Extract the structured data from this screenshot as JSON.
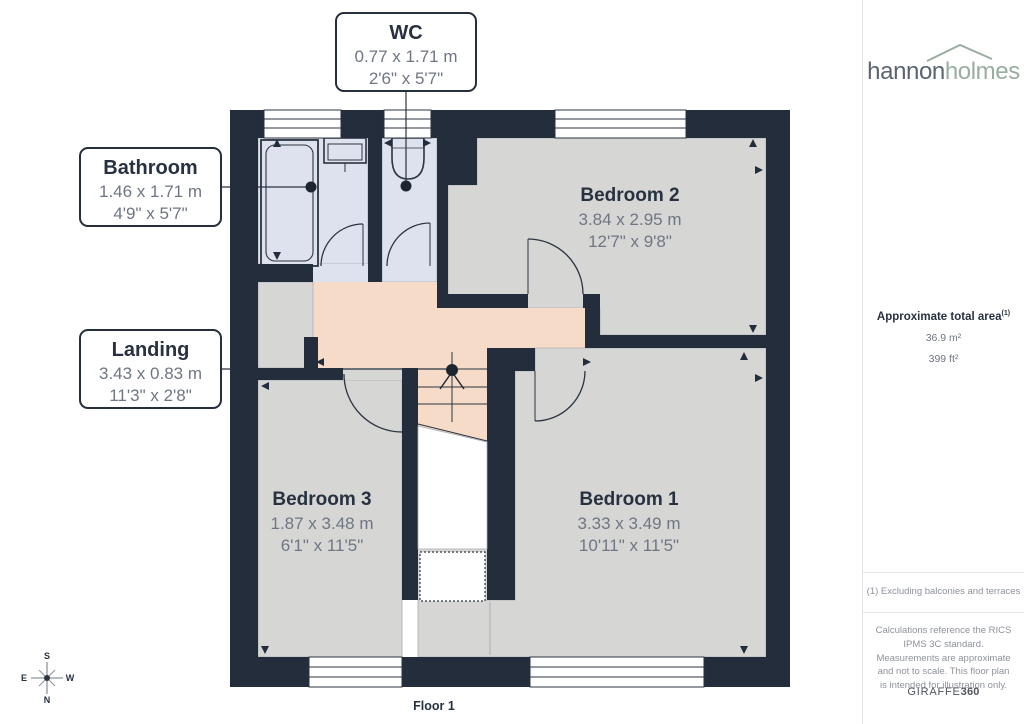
{
  "plan": {
    "floor_label": "Floor 1",
    "callouts": {
      "wc": {
        "title": "WC",
        "metric": "0.77 x 1.71 m",
        "imperial": "2'6\" x 5'7\""
      },
      "bathroom": {
        "title": "Bathroom",
        "metric": "1.46 x 1.71 m",
        "imperial": "4'9\" x 5'7\""
      },
      "landing": {
        "title": "Landing",
        "metric": "3.43 x 0.83 m",
        "imperial": "11'3\" x 2'8\""
      }
    },
    "rooms": {
      "bedroom2": {
        "title": "Bedroom 2",
        "metric": "3.84 x 2.95 m",
        "imperial": "12'7\" x 9'8\""
      },
      "bedroom3": {
        "title": "Bedroom 3",
        "metric": "1.87 x 3.48 m",
        "imperial": "6'1\" x 11'5\""
      },
      "bedroom1": {
        "title": "Bedroom 1",
        "metric": "3.33 x 3.49 m",
        "imperial": "10'11\" x 11'5\""
      }
    },
    "compass": {
      "top": "S",
      "left": "E",
      "right": "W",
      "bottom": "N"
    }
  },
  "sidebar": {
    "logo": {
      "part1": "hannon",
      "part2": "holmes"
    },
    "area": {
      "label": "Approximate total area",
      "sup": "(1)",
      "metric": "36.9 m²",
      "imperial": "399 ft²"
    },
    "footnote": "(1) Excluding balconies and terraces",
    "disclaimer": "Calculations reference the RICS IPMS 3C standard. Measurements are approximate and not to scale. This floor plan is intended for illustration only.",
    "brand": {
      "part1": "GIRAFFE",
      "part2": "360"
    }
  },
  "colors": {
    "wall": "#232d3c",
    "room_gray": "#d6d6d4",
    "wet_room": "#dde2ee",
    "landing": "#f6dcc8",
    "accent_green": "#98ae9f"
  }
}
